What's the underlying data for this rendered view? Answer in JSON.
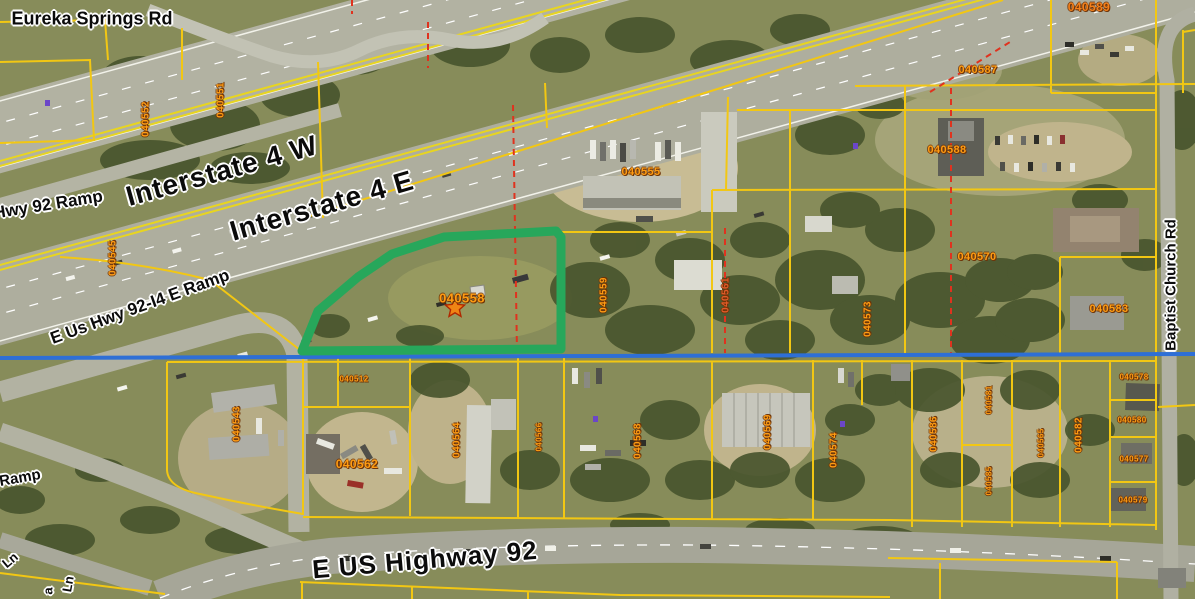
{
  "map": {
    "type": "aerial-parcel-map",
    "selected_parcel": {
      "id": "040558",
      "marker": "star",
      "outline_color": "#27a75b"
    },
    "colors": {
      "parcel_line_yellow": "#f2c713",
      "highlight_green": "#27a75b",
      "section_line_blue": "#2e6fd6",
      "boundary_red_dashed": "#e0321e",
      "parcel_label_orange": "#ff9c12",
      "road_label_black": "#0b0b0b"
    },
    "labels": {
      "roads": [
        {
          "text": "Eureka Springs Rd"
        },
        {
          "text": "Interstate 4 W"
        },
        {
          "text": "Interstate 4 E"
        },
        {
          "text": "Hwy 92 Ramp"
        },
        {
          "text": "E Us Hwy 92-I4 E Ramp"
        },
        {
          "text": "E US Highway 92"
        },
        {
          "text": "Baptist Church Rd"
        },
        {
          "text": "Ramp"
        },
        {
          "text": "Ln"
        },
        {
          "text": "a"
        },
        {
          "text": "Ln"
        }
      ],
      "parcels": [
        {
          "id": "040589"
        },
        {
          "id": "040587"
        },
        {
          "id": "040588"
        },
        {
          "id": "040570"
        },
        {
          "id": "040583"
        },
        {
          "id": "040555"
        },
        {
          "id": "040558"
        },
        {
          "id": "040562"
        },
        {
          "id": "040512"
        },
        {
          "id": "040578"
        },
        {
          "id": "040580"
        },
        {
          "id": "040577"
        },
        {
          "id": "040579"
        },
        {
          "id": "040545"
        },
        {
          "id": "040552"
        },
        {
          "id": "040551"
        },
        {
          "id": "040543"
        },
        {
          "id": "040559"
        },
        {
          "id": "040561"
        },
        {
          "id": "040564"
        },
        {
          "id": "040566"
        },
        {
          "id": "040568"
        },
        {
          "id": "040569"
        },
        {
          "id": "040574"
        },
        {
          "id": "040573"
        },
        {
          "id": "040586"
        },
        {
          "id": "040581"
        },
        {
          "id": "040585"
        },
        {
          "id": "040565"
        },
        {
          "id": "040582"
        }
      ]
    }
  }
}
